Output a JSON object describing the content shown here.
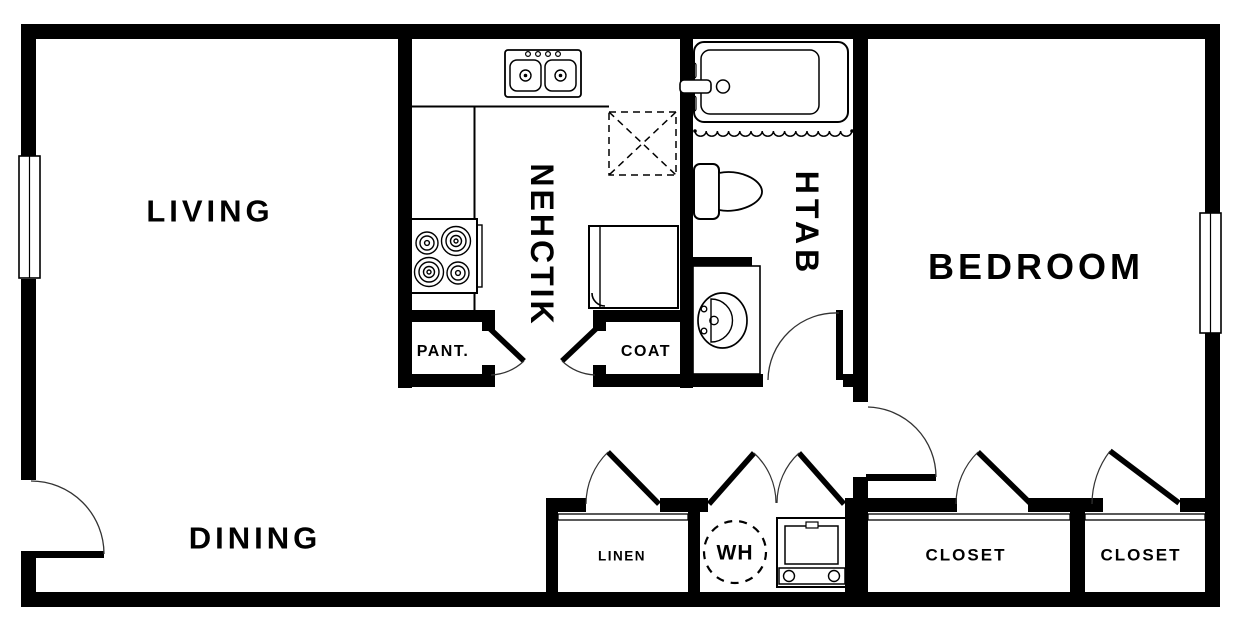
{
  "colors": {
    "wall": "#000000",
    "line": "#1c1c1c",
    "bg": "#ffffff"
  },
  "rooms": {
    "living": {
      "label": "LIVING"
    },
    "kitchen": {
      "label": "KITCHEN"
    },
    "bath": {
      "label": "BATH"
    },
    "bedroom": {
      "label": "BEDROOM"
    },
    "dining": {
      "label": "DINING"
    },
    "pantry": {
      "label": "PANT."
    },
    "coat": {
      "label": "COAT"
    },
    "linen": {
      "label": "LINEN"
    },
    "water_heater": {
      "label": "WH"
    },
    "closet_left": {
      "label": "CLOSET"
    },
    "closet_right": {
      "label": "CLOSET"
    }
  },
  "fixtures": {
    "kitchen_sink": "double-basin-sink",
    "range": "four-burner-range",
    "refrigerator": "refrigerator",
    "upper_cabinet": "dashed-overhead-cabinet",
    "bathtub": "bathtub",
    "shower_curtain": "shower-curtain",
    "toilet": "toilet",
    "vanity_sink": "vanity-sink",
    "washer": "washer",
    "water_heater_tank": "water-heater-tank",
    "window_left": "window",
    "window_right": "window",
    "doors": [
      "entry-door",
      "pantry-door",
      "coat-door",
      "bath-door",
      "bedroom-door",
      "linen-door",
      "wh-double-doors",
      "closet-left-door",
      "closet-right-door"
    ]
  }
}
